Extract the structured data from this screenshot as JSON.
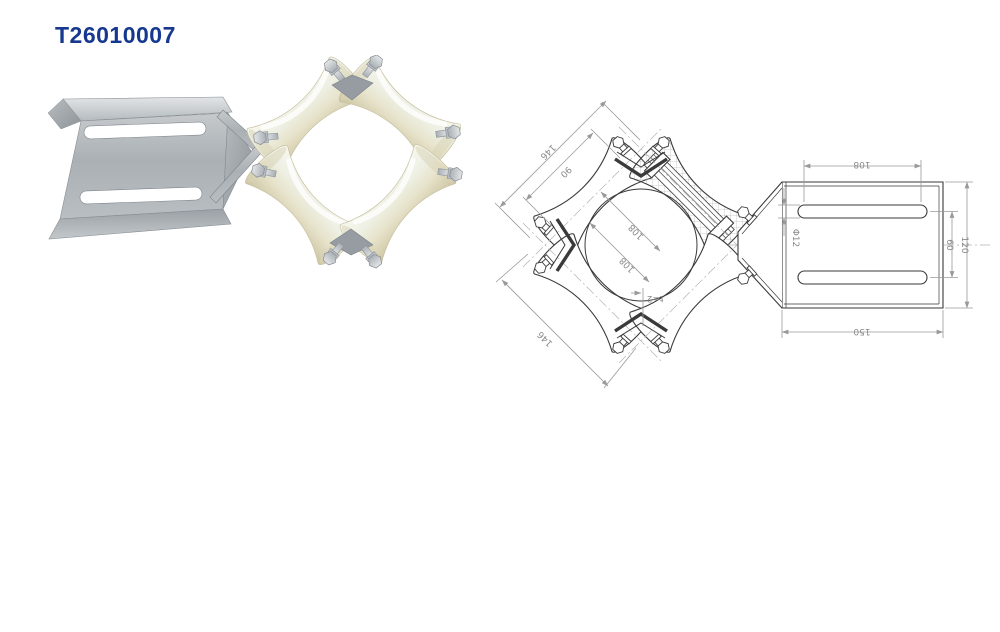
{
  "page": {
    "title": "T26010007",
    "title_color": "#16388E",
    "background": "#FFFFFF"
  },
  "photo": {
    "subject": "cable-guide-roller-assembly",
    "colors": {
      "metal": "#AFB5B9",
      "metal_light": "#DCDFE1",
      "metal_dark": "#82888D",
      "roller": "#EAE6CE",
      "roller_light": "#F7F7EF",
      "roller_shadow": "#CFC8A6"
    }
  },
  "drawing": {
    "colors": {
      "line": "#3A3A3A",
      "dimension": "#9A9A9A"
    },
    "dims": {
      "d146_top": "146",
      "d90": "90",
      "d108_a": "108",
      "d108_b": "108",
      "d146_bottom": "146",
      "thickness": "t=2",
      "slot_length": "108",
      "slot_width": "Φ12",
      "slot_spacing": "60",
      "plate_height": "120",
      "plate_width": "150"
    }
  }
}
